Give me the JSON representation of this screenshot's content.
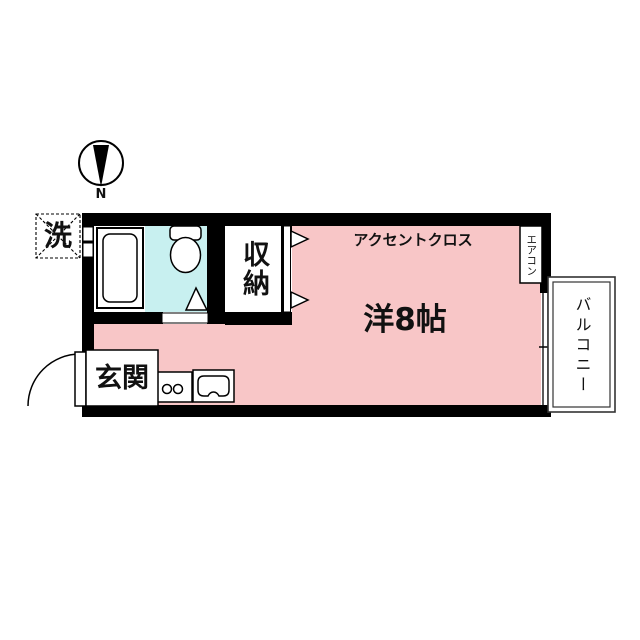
{
  "floorplan": {
    "compass": {
      "north_label": "N"
    },
    "labels": {
      "laundry": "洗",
      "storage": "収納",
      "accent_cross": "アクセントクロス",
      "aircon": "エアコン",
      "room": "洋8帖",
      "balcony": "バルコニー",
      "entrance": "玄関"
    },
    "colors": {
      "room_pink": "#f8c6c7",
      "bath_cyan": "#c8f0f0",
      "wall_black": "#000000"
    }
  }
}
